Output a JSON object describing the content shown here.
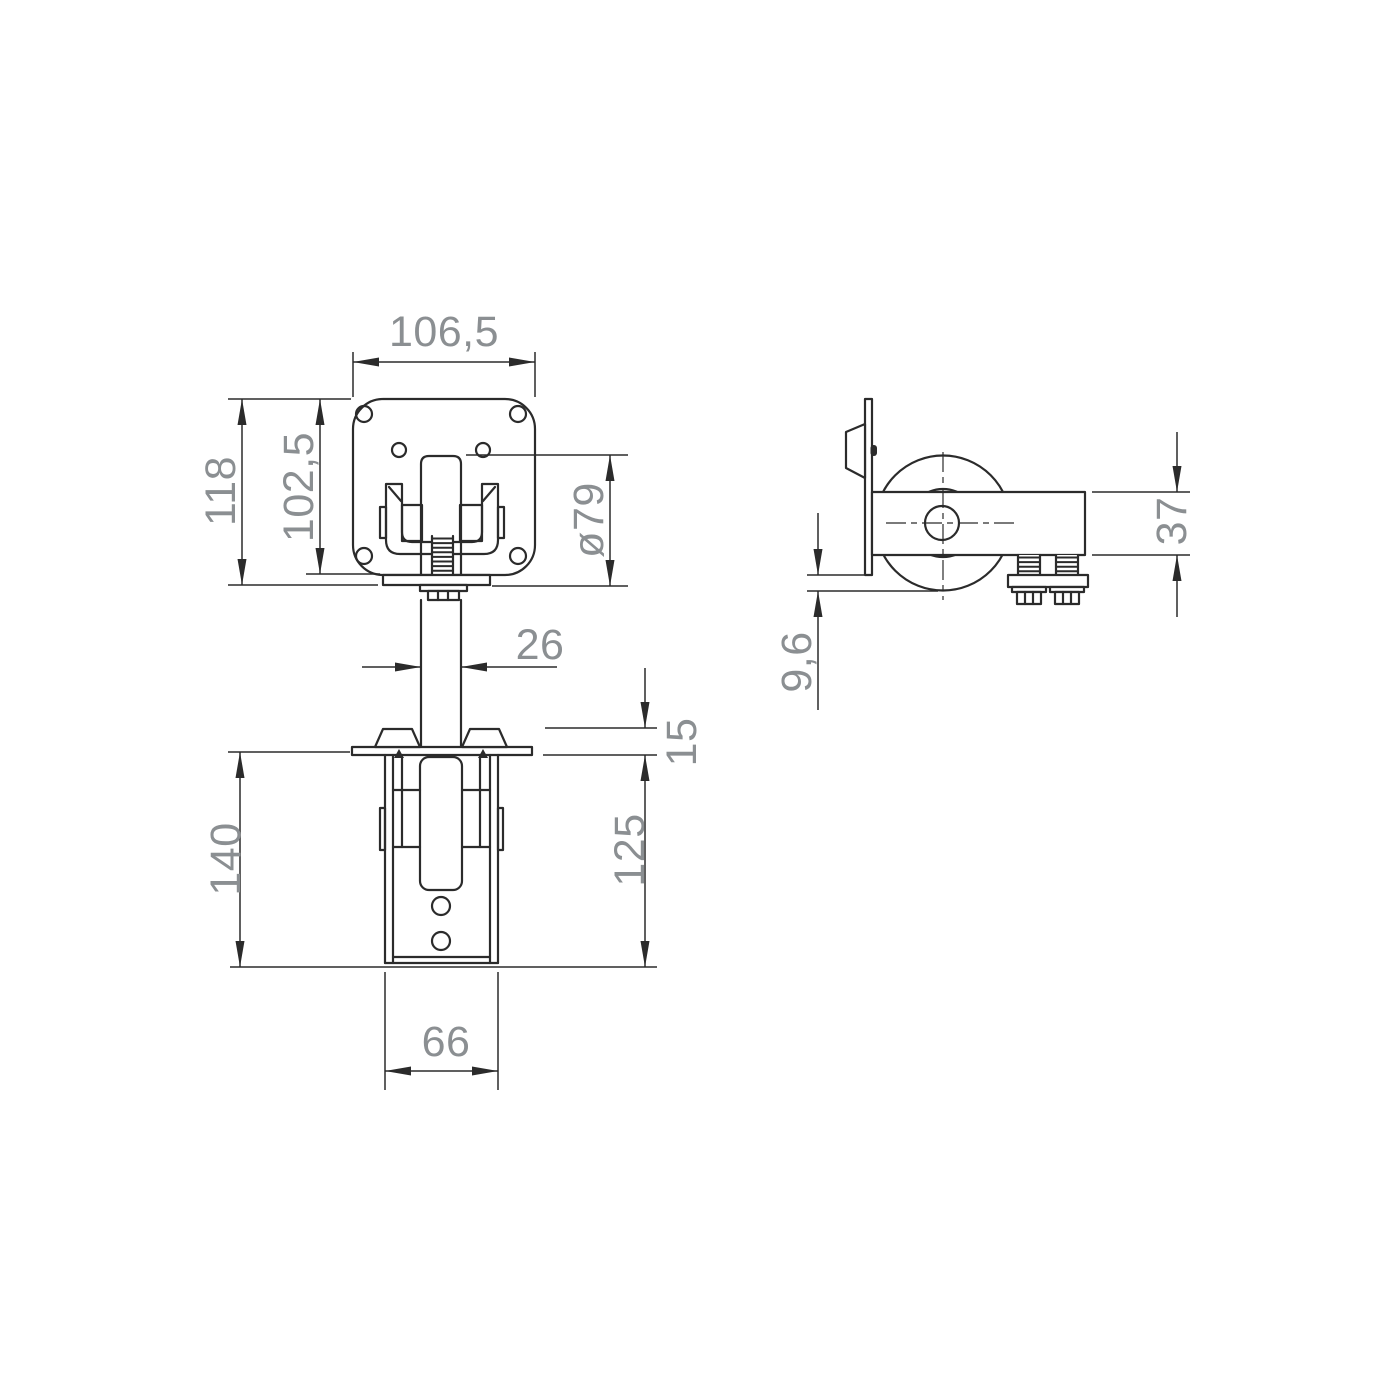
{
  "drawing": {
    "kind": "technical-drawing",
    "colors": {
      "line": "#2b2b2b",
      "dim": "#2b2b2b",
      "dimtext": "#8b8f92",
      "background": "#ffffff"
    },
    "views": [
      {
        "id": "front",
        "label": "front-view"
      },
      {
        "id": "side",
        "label": "side-view"
      },
      {
        "id": "bottom",
        "label": "bottom-view"
      }
    ],
    "dimensions": {
      "front_plate_width": "106,5",
      "front_overall_height": "118",
      "front_inner_height": "102,5",
      "roller_diameter": "ø79",
      "stem_width": "26",
      "side_arm_height": "37",
      "side_plate_offset": "9,6",
      "bottom_plate_height": "15",
      "bottom_overall_height": "140",
      "bottom_body_height": "125",
      "bottom_body_width": "66"
    }
  }
}
